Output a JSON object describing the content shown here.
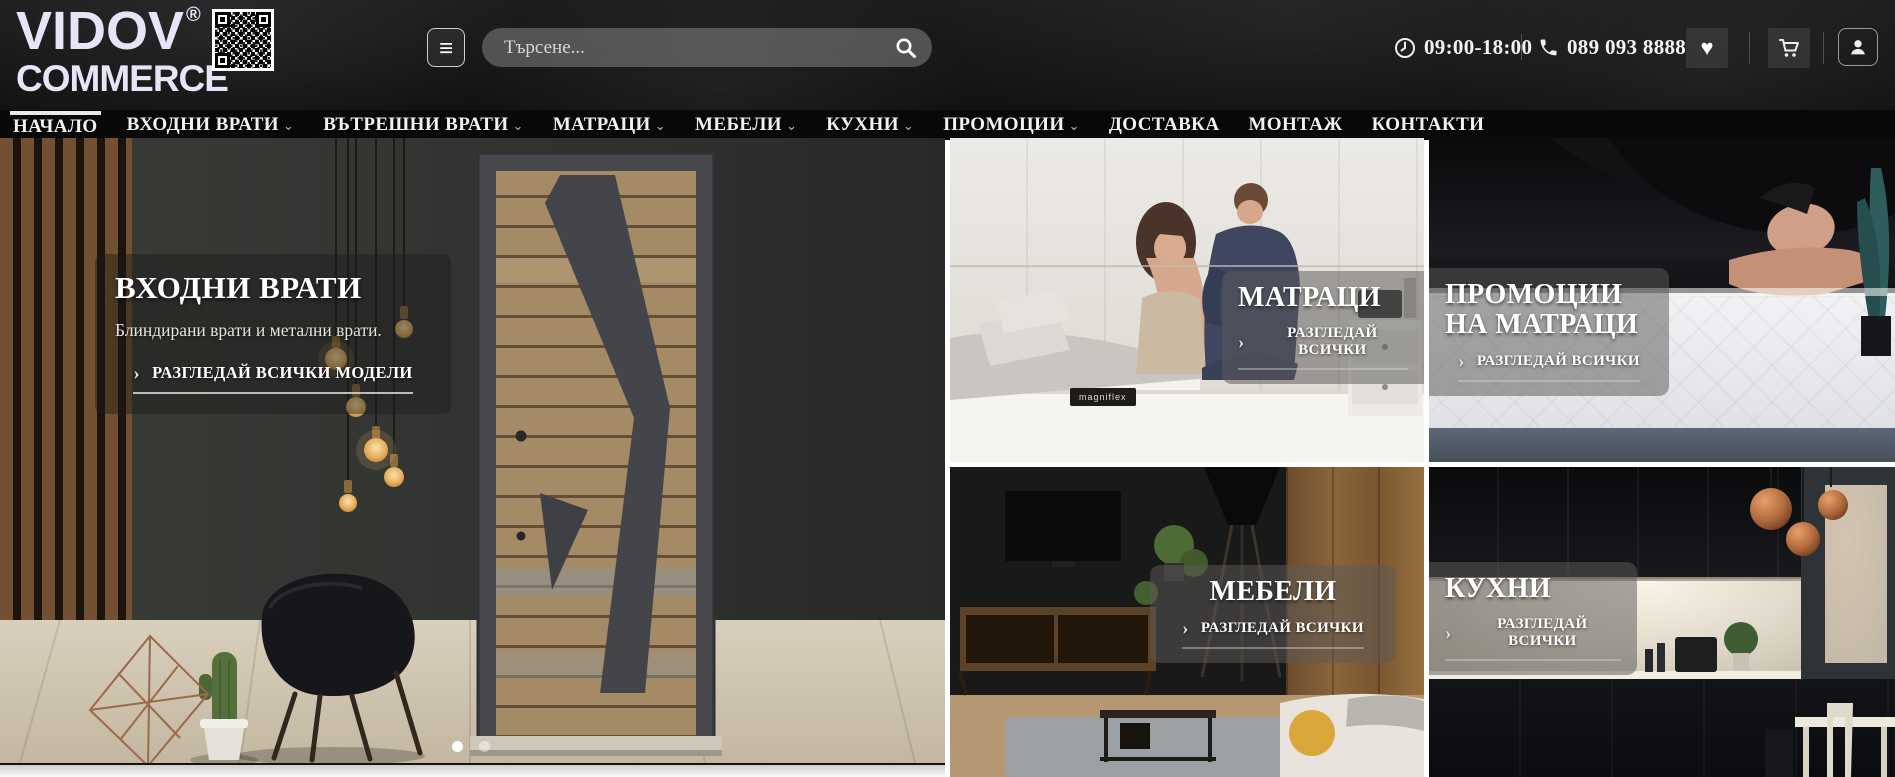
{
  "header": {
    "logo_line1": "VIDOV",
    "logo_reg": "®",
    "logo_line2": "COMMERCE",
    "search_placeholder": "Търсене...",
    "work_hours": "09:00-18:00",
    "phone": "089 093 8888"
  },
  "icons": {
    "hamburger": "≡",
    "heart": "♥",
    "arrow": "›",
    "chevron": "⌄"
  },
  "nav": {
    "items": [
      {
        "label": "НАЧАЛО",
        "active": true,
        "dropdown": false
      },
      {
        "label": "ВХОДНИ ВРАТИ",
        "active": false,
        "dropdown": true
      },
      {
        "label": "ВЪТРЕШНИ ВРАТИ",
        "active": false,
        "dropdown": true
      },
      {
        "label": "МАТРАЦИ",
        "active": false,
        "dropdown": true
      },
      {
        "label": "МЕБЕЛИ",
        "active": false,
        "dropdown": true
      },
      {
        "label": "КУХНИ",
        "active": false,
        "dropdown": true
      },
      {
        "label": "ПРОМОЦИИ",
        "active": false,
        "dropdown": true
      },
      {
        "label": "ДОСТАВКА",
        "active": false,
        "dropdown": false
      },
      {
        "label": "МОНТАЖ",
        "active": false,
        "dropdown": false
      },
      {
        "label": "КОНТАКТИ",
        "active": false,
        "dropdown": false
      }
    ]
  },
  "hero": {
    "title": "ВХОДНИ ВРАТИ",
    "subtitle": "Блиндирани врати и метални врати.",
    "cta_label": "РАЗГЛЕДАЙ ВСИЧКИ МОДЕЛИ",
    "slide_count": 2,
    "active_slide": 1
  },
  "tiles": [
    {
      "title": "МАТРАЦИ",
      "cta_label": "РАЗГЛЕДАЙ ВСИЧКИ",
      "brand_tag": "magniflex"
    },
    {
      "title": "ПРОМОЦИИ НА МАТРАЦИ",
      "cta_label": "РАЗГЛЕДАЙ ВСИЧКИ"
    },
    {
      "title": "МЕБЕЛИ",
      "cta_label": "РАЗГЛЕДАЙ ВСИЧКИ"
    },
    {
      "title": "КУХНИ",
      "cta_label": "РАЗГЛЕДАЙ ВСИЧКИ"
    }
  ],
  "colors": {
    "header_bg": "#171717",
    "nav_bg": "#090909",
    "text_light": "#f4f2ee",
    "overlay_panel": "rgba(92,90,88,0.52)",
    "accent_wood": "#8a6438"
  }
}
